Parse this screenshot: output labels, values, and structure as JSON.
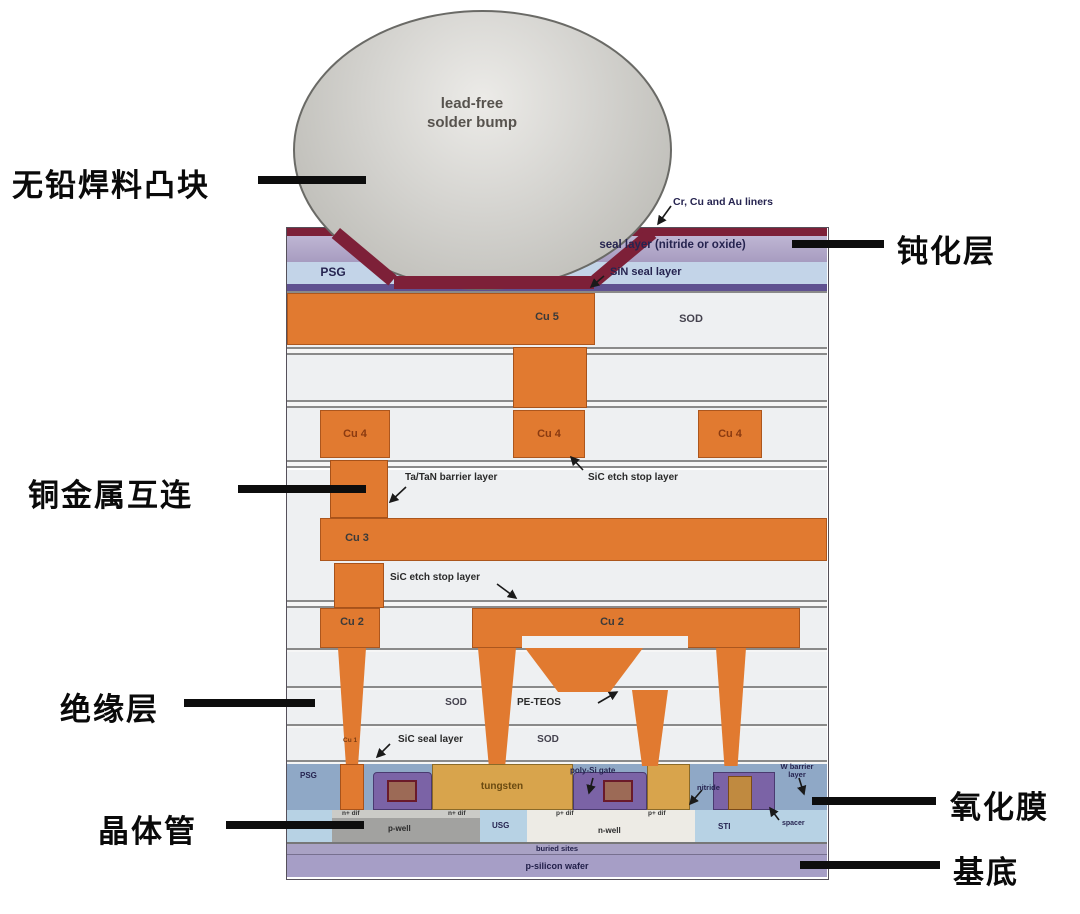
{
  "figure": {
    "title": "CMOS chip cross-section diagram",
    "bump": {
      "line1": "lead-free",
      "line2": "solder bump"
    },
    "labels": {
      "liners": "Cr, Cu and Au liners",
      "seal_layer": "seal layer (nitride or oxide)",
      "psg_top": "PSG",
      "sin_seal": "SiN seal layer",
      "cu5": "Cu 5",
      "sod1": "SOD",
      "cu4_a": "Cu 4",
      "cu4_b": "Cu 4",
      "cu4_c": "Cu 4",
      "tatan": "Ta/TaN barrier layer",
      "sic_etch_a": "SiC etch stop layer",
      "cu3": "Cu 3",
      "sic_etch_b": "SiC etch stop layer",
      "cu2_a": "Cu 2",
      "cu2_b": "Cu 2",
      "sod2": "SOD",
      "peteos": "PE-TEOS",
      "cu1": "Cu 1",
      "sic_seal": "SiC seal layer",
      "sod3": "SOD",
      "psg_feol": "PSG",
      "tungsten": "tungsten",
      "poly_gate": "poly-Si gate",
      "nitride": "nitride",
      "w_barrier_1": "W barrier",
      "w_barrier_2": "layer",
      "usg_a": "USG",
      "usg_b": "USG",
      "ndif_a": "n+ dif",
      "ndif_b": "n+ dif",
      "pdif_a": "p+ dif",
      "pdif_b": "p+ dif",
      "pwell": "p-well",
      "nwell": "n-well",
      "sti": "STI",
      "spacer": "spacer",
      "buried": "buried sites",
      "wafer": "p-silicon wafer"
    },
    "callouts": {
      "bump_cn": "无铅焊料凸块",
      "passivation_cn": "钝化层",
      "interconnect_cn": "铜金属互连",
      "insulation_cn": "绝缘层",
      "transistor_cn": "晶体管",
      "oxide_cn": "氧化膜",
      "substrate_cn": "基底"
    },
    "colors": {
      "copper": "#e17a30",
      "liner_red": "#7d2038",
      "seal_lavender": "#b3a9c9",
      "psg_blue": "#c3d4e8",
      "dielectric_white": "#eef0f2",
      "oxide_blue": "#8fa8c6",
      "tungsten_tan": "#d8a44c",
      "gate_purple": "#7b63a6",
      "sti_blue": "#b7d2e4",
      "wafer_purple": "#a69ec6",
      "bump_gray": "#c9c9c5",
      "callout_black": "#0a0a0a"
    }
  }
}
